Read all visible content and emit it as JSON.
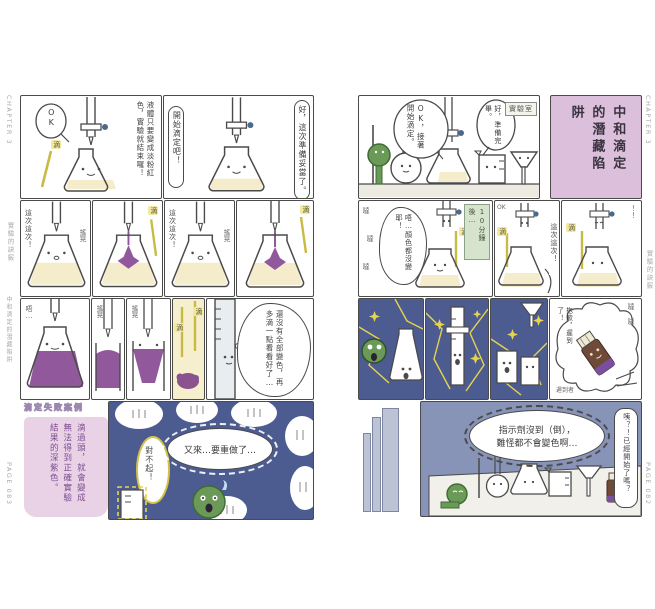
{
  "colors": {
    "title_panel_pink": "#dcc0db",
    "dark_panel_blue": "#4d5c90",
    "star_yellow": "#e6d44e",
    "bottom_panel_blue": "#8793b7",
    "liquid_yellow": "#f4ecca",
    "indicator_purple": "#92589c",
    "character_green": "#6b9a58",
    "bottle_brown": "#6f4a39",
    "bottle_band_purple": "#7b4f9f",
    "drip_streak_yellow": "#c8bb45",
    "timebox_green": "#d6e4cd",
    "infobox_pink": "#e9d2e6",
    "infobox_text_purple": "#7d4f92"
  },
  "edge_left": {
    "chapter": "CHAPTER 3",
    "header": "實驗的訣竅",
    "section": "中和滴定的潛藏陷阱",
    "page": "PAGE 083"
  },
  "edge_right": {
    "chapter": "CHAPTER 3",
    "header": "實驗的訣竅",
    "page": "PAGE 082"
  },
  "left_page": {
    "r1a": {
      "ok": "OK",
      "drip": "滴",
      "caption": "液體只要變成淡粉紅色，實驗就結束囉！"
    },
    "r1b": {
      "right_bubble": "好，這次準備妥當了。",
      "left_bubble": "開始滴定吧！"
    },
    "r2": {
      "p1_side": "這次這次！",
      "p1_sfx": "搖晃",
      "p2_drip": "滴",
      "p3_side": "這次這次！",
      "p3_sfx": "搖晃",
      "p4_drip": "滴"
    },
    "r3": {
      "p1_sfx": "唔…",
      "p2_sfx": "搖晃",
      "p3_sfx": "搖晃",
      "p4_drip_a": "滴",
      "p4_drip_b": "滴",
      "p5_bubble": "還沒有全部變色，再多滴一點看看好了…"
    },
    "r4": {
      "info_title": "滴定失敗案例",
      "info_body": "滴過頭，就會變成無法得到正確實驗結果的深紫色。",
      "sorry": "對不起！",
      "main": "又來…要重做了…"
    }
  },
  "right_page": {
    "r1": {
      "bubble_ok": "OK，接著開始滴定。",
      "bubble_ready": "好，準備完畢。",
      "sign": "實驗室",
      "title": "中和滴定的潛藏陷阱"
    },
    "r2": {
      "p1_sfx_a": "噠",
      "p1_sfx_b": "噠",
      "p1_sfx_c": "噠",
      "p1_bubble": "唔…顏色都沒變耶！",
      "p1_drip": "滴",
      "timebox": "10分鐘後…",
      "p2_ok": "OK",
      "p2_drip": "滴",
      "p2_bubble": "這次這次！",
      "p3_drip": "滴",
      "p3_sfx": "！！"
    },
    "r3": {
      "bottle_bubble": "抱歉，遲到了！",
      "bottle_sfx": "噠 噠",
      "bottle_caption": "遲到者"
    },
    "r4": {
      "main_l1": "指示劑沒到（倒），",
      "main_l2": "難怪都不會變色啊…",
      "side": "咦？！已經開始了嗎？"
    }
  }
}
